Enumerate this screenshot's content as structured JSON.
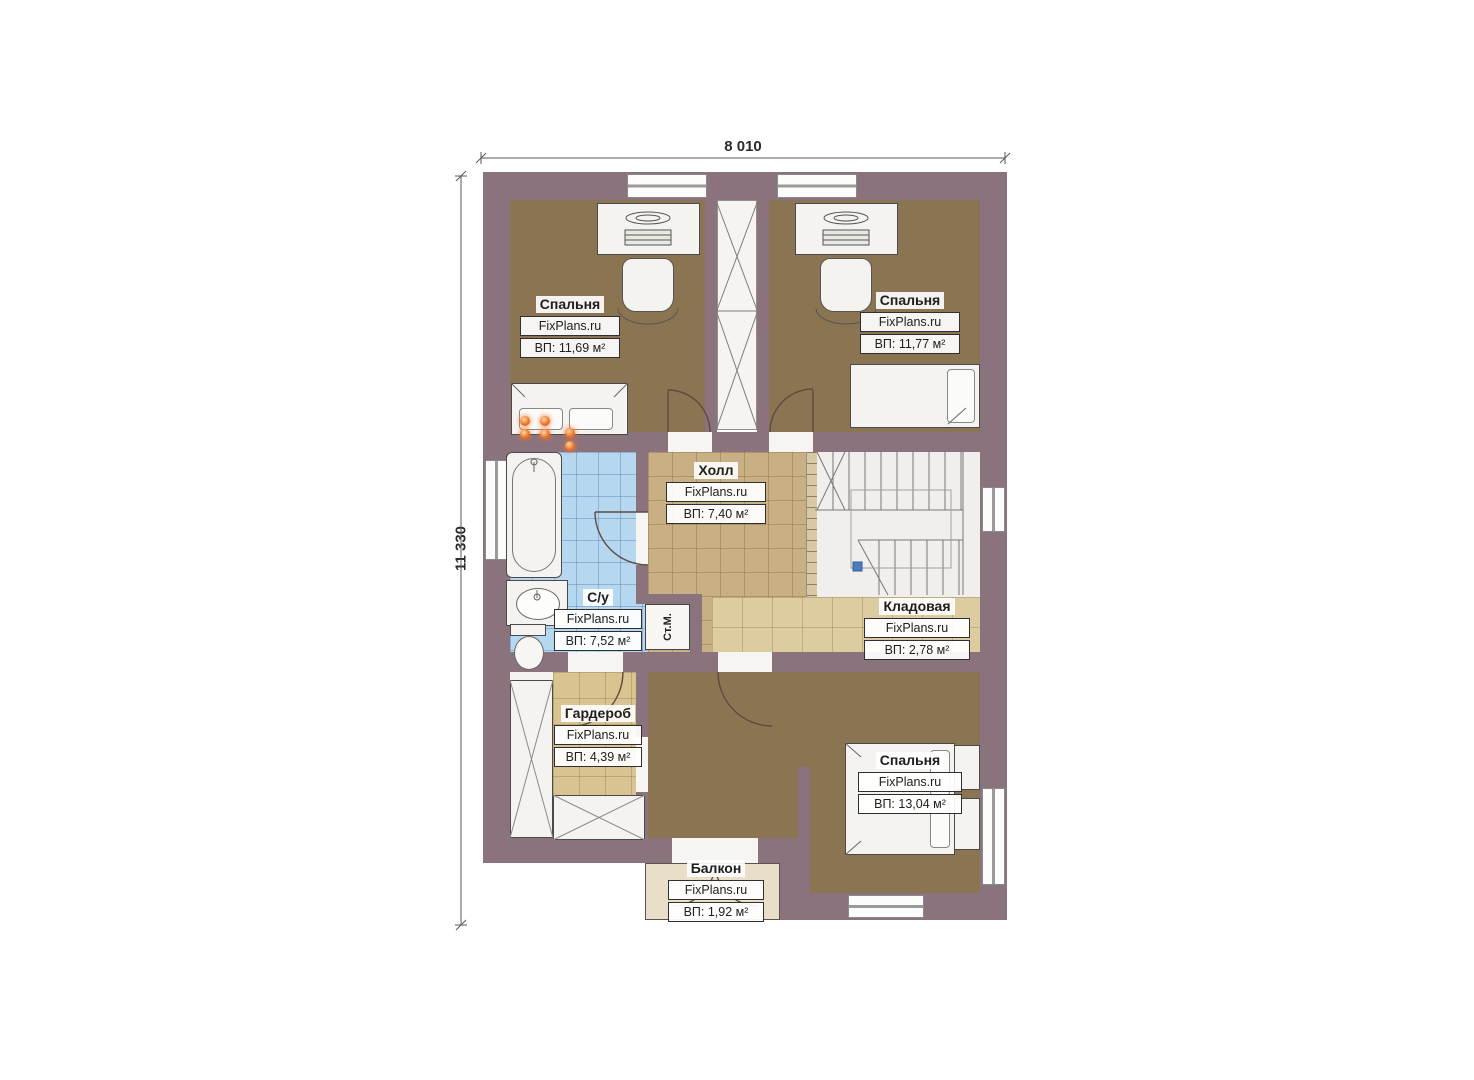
{
  "plan_title": "Floor plan, second storey",
  "dimensions": {
    "width_label": "8 010",
    "height_label": "11 330"
  },
  "rooms": [
    {
      "id": "bedroom-1",
      "name": "Спальня",
      "brand": "FixPlans.ru",
      "area": "ВП: 11,69 м²"
    },
    {
      "id": "bedroom-2",
      "name": "Спальня",
      "brand": "FixPlans.ru",
      "area": "ВП: 11,77 м²"
    },
    {
      "id": "hall",
      "name": "Холл",
      "brand": "FixPlans.ru",
      "area": "ВП: 7,40 м²"
    },
    {
      "id": "bathroom",
      "name": "С/у",
      "brand": "FixPlans.ru",
      "area": "ВП: 7,52 м²"
    },
    {
      "id": "storage",
      "name": "Кладовая",
      "brand": "FixPlans.ru",
      "area": "ВП: 2,78 м²"
    },
    {
      "id": "wardrobe",
      "name": "Гардероб",
      "brand": "FixPlans.ru",
      "area": "ВП: 4,39 м²"
    },
    {
      "id": "bedroom-3",
      "name": "Спальня",
      "brand": "FixPlans.ru",
      "area": "ВП: 13,04 м²"
    },
    {
      "id": "balcony",
      "name": "Балкон",
      "brand": "FixPlans.ru",
      "area": "ВП: 1,92 м²"
    }
  ],
  "fixtures": {
    "washing_machine": "Ст.М."
  },
  "colors": {
    "wall": "#8b737e",
    "floor_brown": "#8a7452",
    "tile_blue": "#b5d7f0",
    "tile_tan": "#c8b084",
    "tile_light": "#dccc9f",
    "balcony_floor": "#e9dfc9",
    "accent_orange": "#ee7429",
    "stair_marker_blue": "#4d7cc3"
  }
}
